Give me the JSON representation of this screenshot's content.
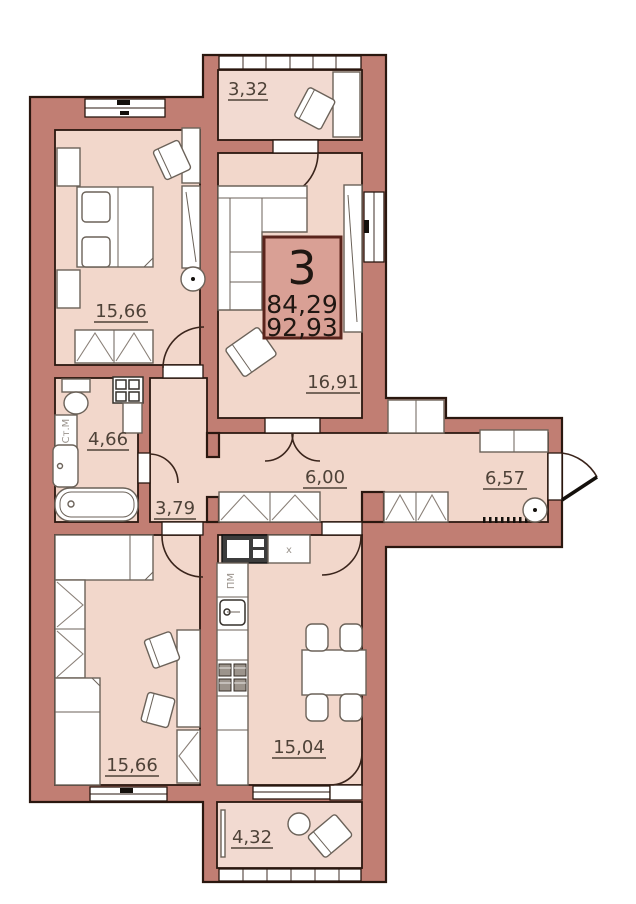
{
  "plan": {
    "info_box": {
      "number": "3",
      "area_living": "84,29",
      "area_total": "92,93"
    },
    "rooms": [
      {
        "id": "balcony-top",
        "label": "3,32"
      },
      {
        "id": "bedroom",
        "label": "15,66"
      },
      {
        "id": "living-room",
        "label": "16,91"
      },
      {
        "id": "bathroom",
        "label": "4,66"
      },
      {
        "id": "hall",
        "label": "3,79"
      },
      {
        "id": "corridor",
        "label": "6,00"
      },
      {
        "id": "entry-corridor",
        "label": "6,57"
      },
      {
        "id": "room-lower",
        "label": "15,66"
      },
      {
        "id": "kitchen",
        "label": "15,04"
      },
      {
        "id": "balcony-bottom",
        "label": "4,32"
      }
    ],
    "appliances": {
      "washer": "Ст.М",
      "dishwasher": "ПМ",
      "fridge": "x"
    },
    "colors": {
      "wall": "#c17e73",
      "room": "#f2d7cb",
      "balcony": "#f2dad1",
      "outline": "#2a170f",
      "info_fill": "#d9a095",
      "info_border": "#5a241c",
      "label": "#4e4238"
    }
  }
}
